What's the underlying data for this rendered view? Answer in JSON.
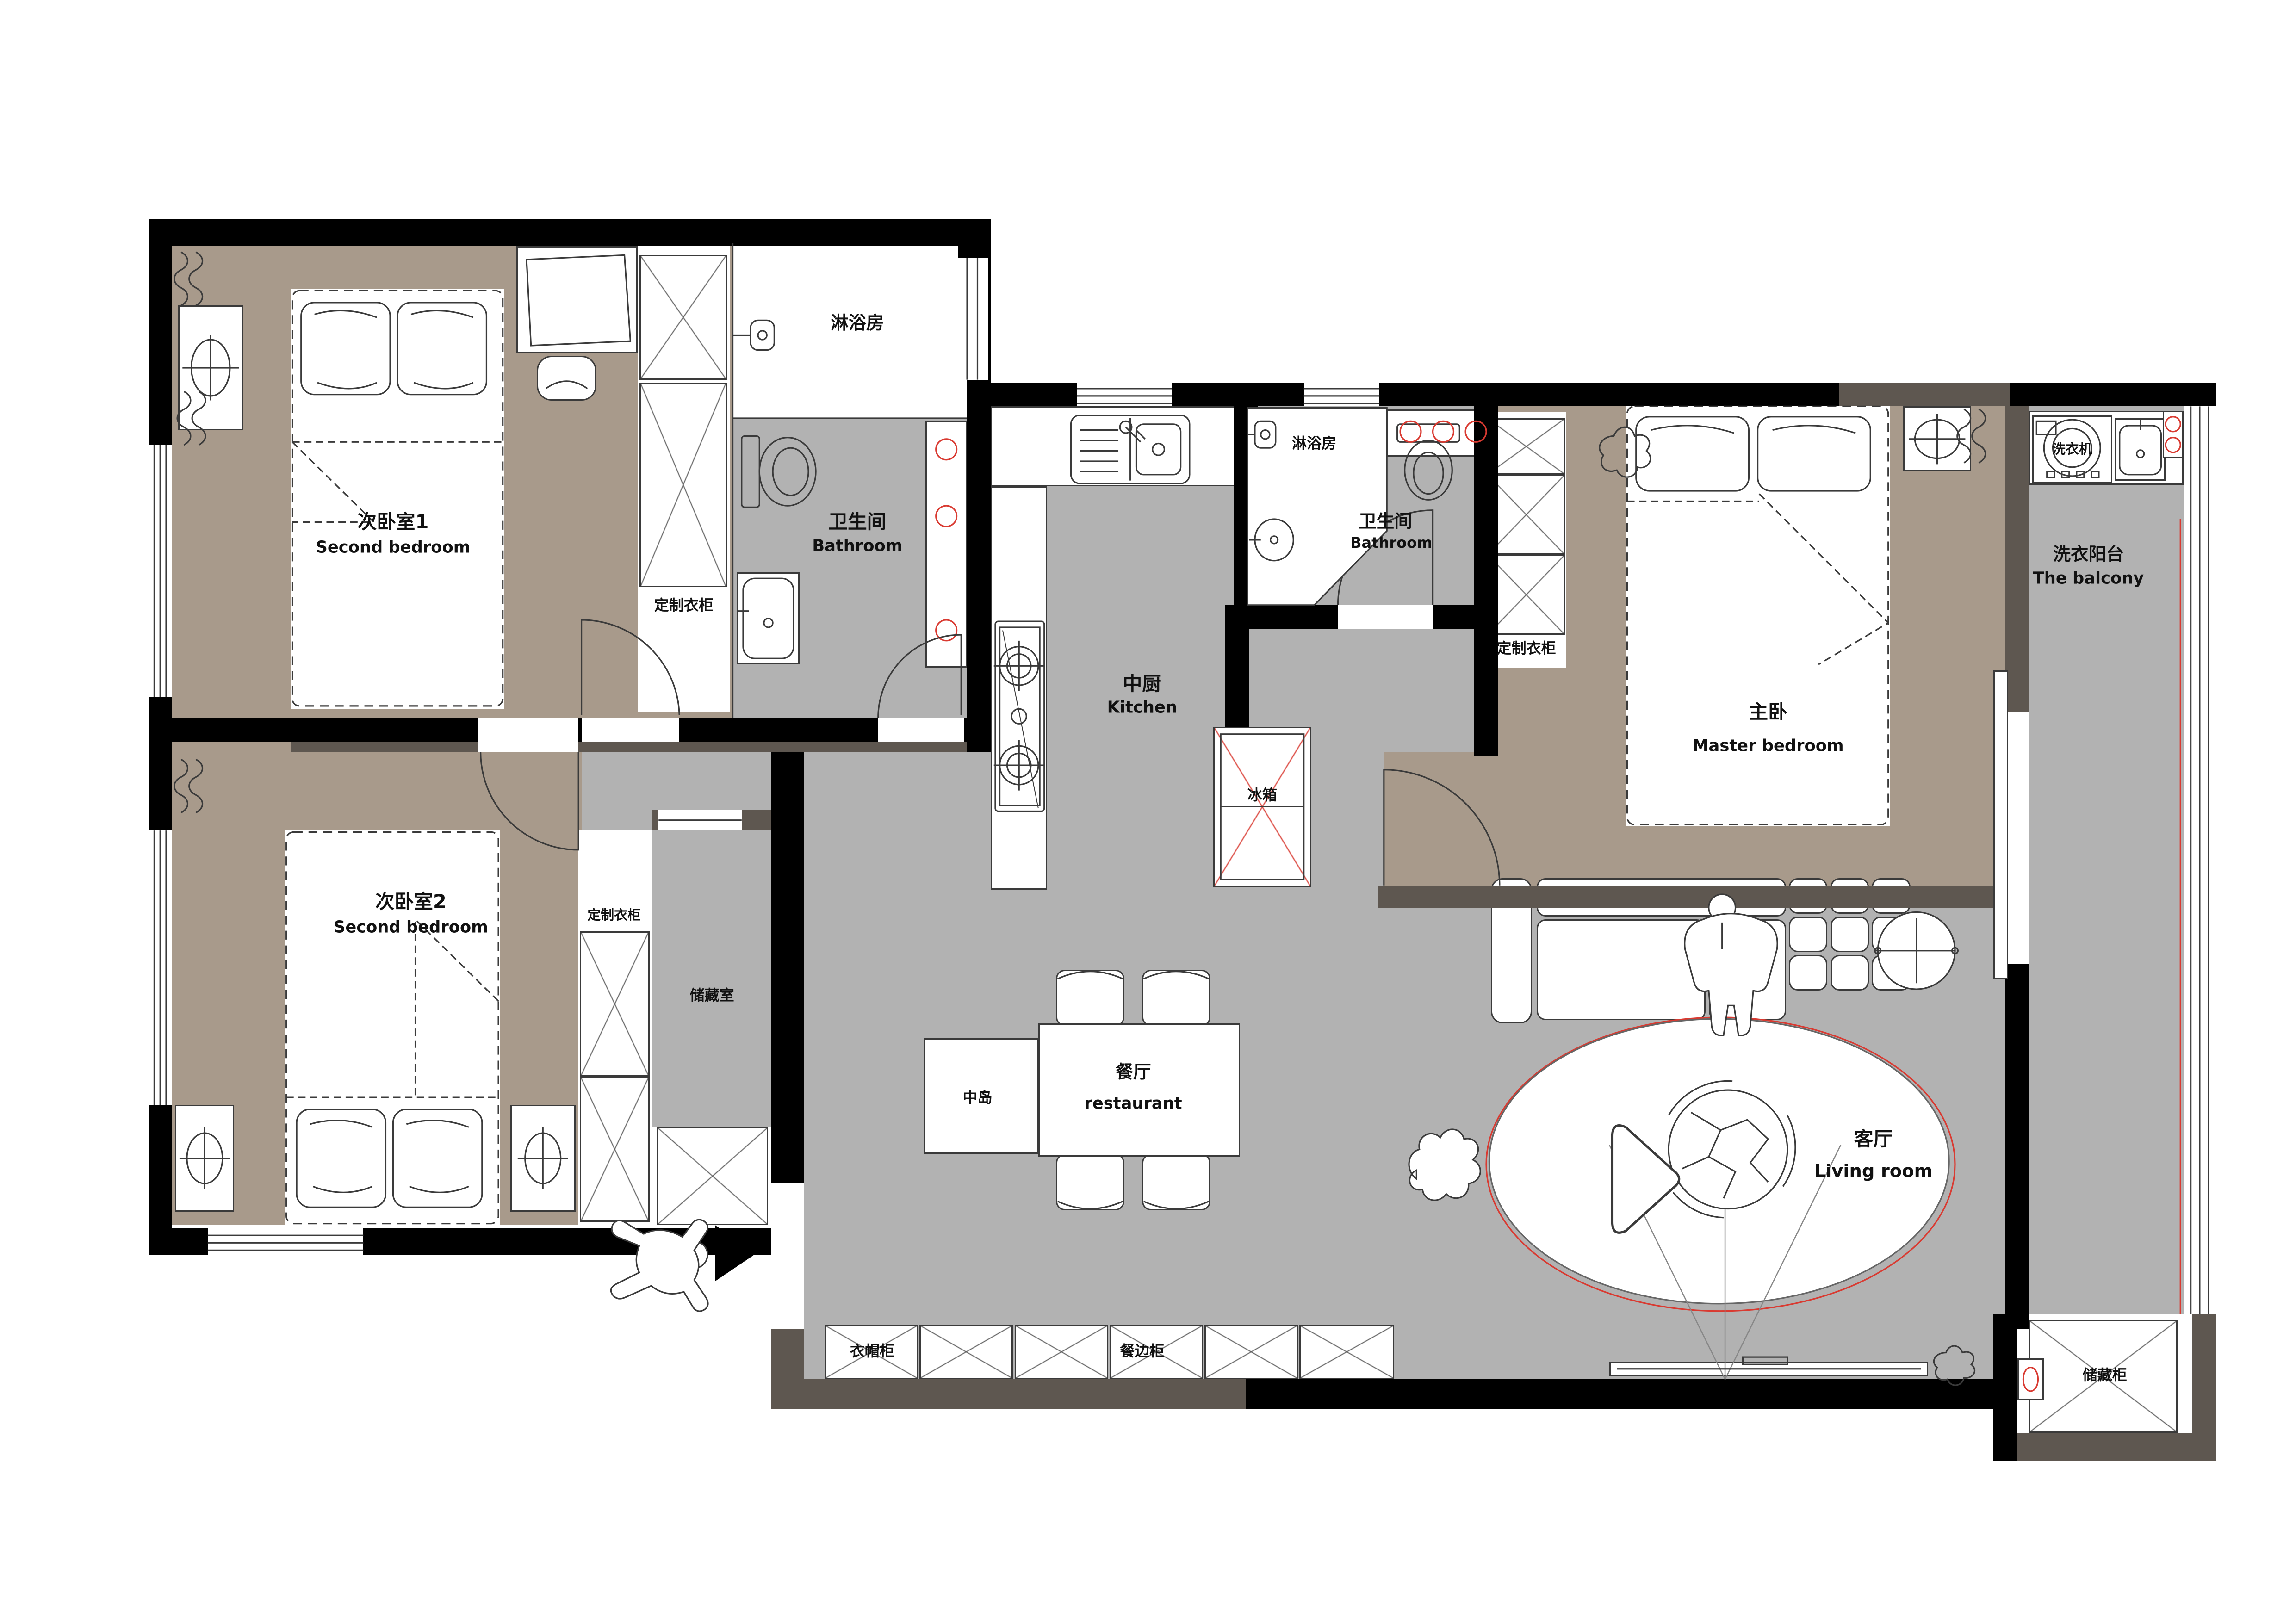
{
  "palette": {
    "wall_black": "#000000",
    "wall_dark_gray": "#5e5750",
    "floor_bedroom": "#a89a8b",
    "floor_gray": "#b2b2b2",
    "accent_red": "#d93a31",
    "line": "#3a3a3a"
  },
  "rooms": {
    "second_bedroom_1": {
      "zh": "次卧室1",
      "en": "Second bedroom"
    },
    "second_bedroom_2": {
      "zh": "次卧室2",
      "en": "Second bedroom"
    },
    "master_bedroom": {
      "zh": "主卧",
      "en": "Master bedroom"
    },
    "bathroom_1": {
      "zh": "卫生间",
      "en": "Bathroom"
    },
    "bathroom_2": {
      "zh": "卫生间",
      "en": "Bathroom"
    },
    "shower_1": {
      "zh": "淋浴房"
    },
    "shower_2": {
      "zh": "淋浴房"
    },
    "kitchen": {
      "zh": "中厨",
      "en": "Kitchen"
    },
    "dining": {
      "zh": "餐厅",
      "en": "restaurant"
    },
    "living_room": {
      "zh": "客厅",
      "en": "Living room"
    },
    "laundry_balcony": {
      "zh": "洗衣阳台",
      "en": "The balcony"
    },
    "storage_room": {
      "zh": "储藏室"
    }
  },
  "fixtures": {
    "custom_wardrobe_1": "定制衣柜",
    "custom_wardrobe_2": "定制衣柜",
    "custom_wardrobe_master": "定制衣柜",
    "kitchen_island": "中岛",
    "fridge": "冰箱",
    "washing_machine": "洗衣机",
    "cloak_cabinet": "衣帽柜",
    "sideboard_cabinet": "餐边柜",
    "storage_cabinet": "储藏柜"
  }
}
